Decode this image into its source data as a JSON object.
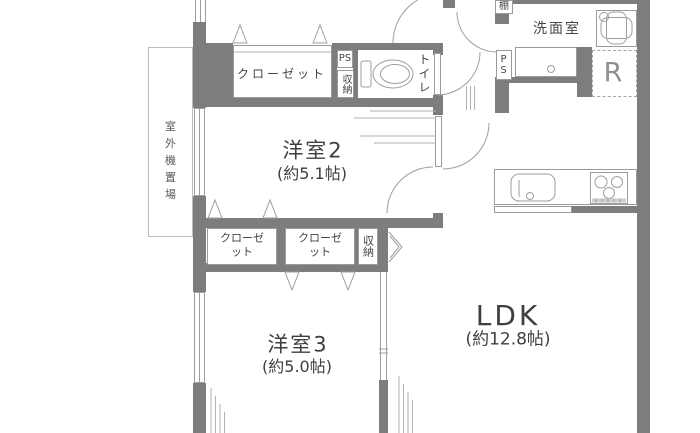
{
  "rooms": {
    "yoshitsu2": {
      "name": "洋室2",
      "size": "(約5.1帖)"
    },
    "yoshitsu3": {
      "name": "洋室3",
      "size": "(約5.0帖)"
    },
    "ldk": {
      "name": "LDK",
      "size": "(約12.8帖)"
    },
    "senmenshitsu": {
      "name": "洗面室"
    },
    "toilet": {
      "name": "トイレ"
    }
  },
  "storage": {
    "closet_yoshitsu2": "クローゼット",
    "closet_left": "クローゼット",
    "closet_right": "クローゼット",
    "shuno_upper": "収納",
    "shuno_lower": "収納",
    "shelf": "棚"
  },
  "utility": {
    "ps_upper": "PS",
    "ps_hall": "PS",
    "refrigerator_space": "R",
    "outdoor_unit_area": "室外機置場"
  },
  "symbols": {
    "toilet_fixture": "toilet-icon",
    "washing_machine": "washing-machine-icon",
    "washbasin": "washbasin-icon",
    "kitchen_sink": "kitchen-sink-icon",
    "gas_stove": "gas-stove-icon",
    "door_arcs": "swing-door-arc",
    "hanger_marks": "closet-hanger-triangle",
    "windows": "window-glazing-lines"
  },
  "colors": {
    "wall": "#7d7d7d",
    "line": "#9e9e9e",
    "text": "#454545",
    "background": "#ffffff"
  }
}
